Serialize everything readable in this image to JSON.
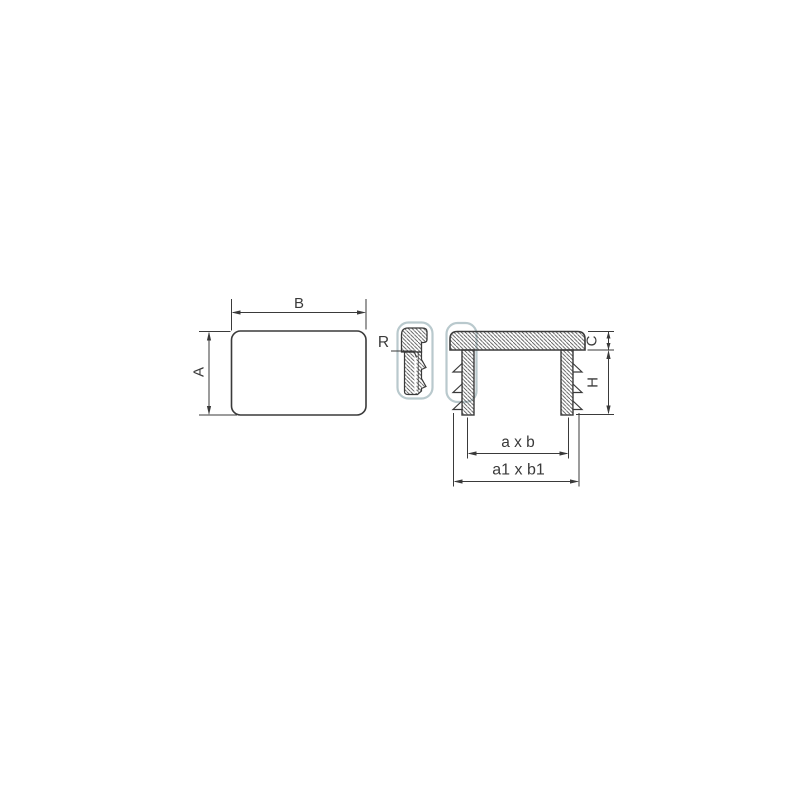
{
  "page": {
    "background": "#ffffff"
  },
  "drawing": {
    "line_color": "#3a3a3a",
    "hatch_color": "#4a4a4a",
    "highlight_color": "#b9c9cd",
    "front_view": {
      "width_label": "B",
      "height_label": "A"
    },
    "corner_detail": {
      "radius_label": "R"
    },
    "section_view": {
      "flange_thickness_label": "C",
      "insert_depth_label": "H",
      "inner_size_label": "a x b",
      "outer_size_label": "a1 x b1"
    }
  }
}
